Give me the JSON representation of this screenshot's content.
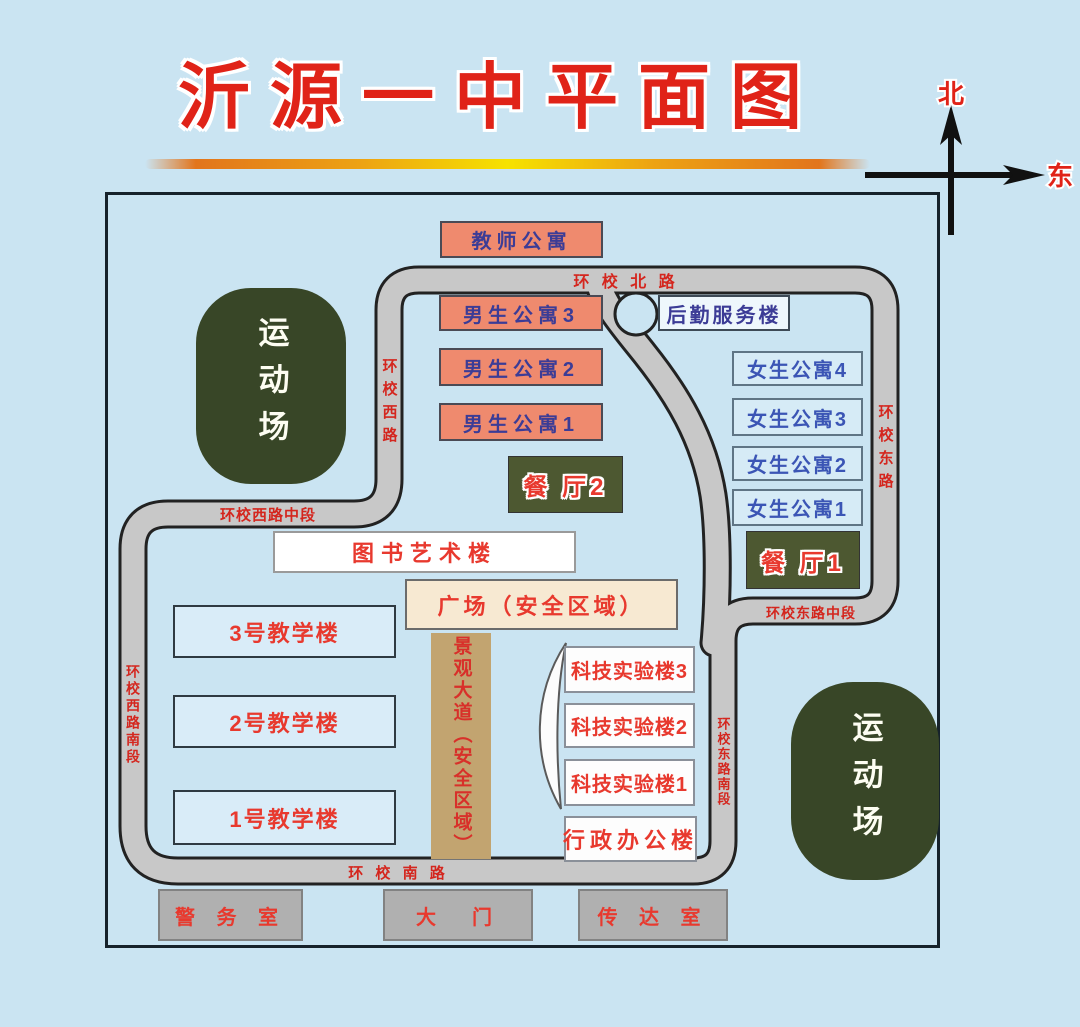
{
  "page": {
    "title": "沂源一中平面图"
  },
  "compass": {
    "north": "北",
    "east": "东"
  },
  "fields": {
    "west": "运动场",
    "east": "运动场"
  },
  "buildings": {
    "teacher_apartment": "教师公寓",
    "boys_dorm_3": "男生公寓3",
    "boys_dorm_2": "男生公寓2",
    "boys_dorm_1": "男生公寓1",
    "logistics_service": "后勤服务楼",
    "girls_dorm_4": "女生公寓4",
    "girls_dorm_3": "女生公寓3",
    "girls_dorm_2": "女生公寓2",
    "girls_dorm_1": "女生公寓1",
    "dining_hall_2": "餐 厅2",
    "dining_hall_1": "餐 厅1",
    "library_art": "图书艺术楼",
    "plaza": "广场（安全区域）",
    "teaching_3": "3号教学楼",
    "teaching_2": "2号教学楼",
    "teaching_1": "1号教学楼",
    "landscape_avenue": "景观大道（安全区域）",
    "science_lab_3": "科技实验楼3",
    "science_lab_2": "科技实验楼2",
    "science_lab_1": "科技实验楼1",
    "admin_office": "行政办公楼",
    "police_room": "警 务 室",
    "main_gate": "大　门",
    "reception": "传 达 室"
  },
  "roads": {
    "north_ring": "环 校 北 路",
    "west_ring": "环校西路",
    "west_ring_middle": "环校西路中段",
    "west_ring_south": "环校西路南段",
    "south_ring": "环 校 南 路",
    "east_ring": "环校东路",
    "east_ring_middle": "环校东路中段",
    "east_ring_south": "环校东路南段"
  },
  "colors": {
    "background": "#cae4f2",
    "title_red": "#e02318",
    "road_fill": "#c8c8c8",
    "road_outline": "#222222",
    "road_label_red": "#d4261e",
    "field_green": "#384627",
    "dorm_salmon": "#ef8a6e",
    "dorm_text_blue": "#3c3c96",
    "girls_box_blue": "#d6ebf6",
    "dining_olive": "#4d5831",
    "plaza_cream": "#f7e9d2",
    "avenue_tan": "#c2a470",
    "teaching_blue": "#d9ecf8",
    "gate_gray": "#b0b0b0",
    "building_label_red": "#e8392e"
  }
}
